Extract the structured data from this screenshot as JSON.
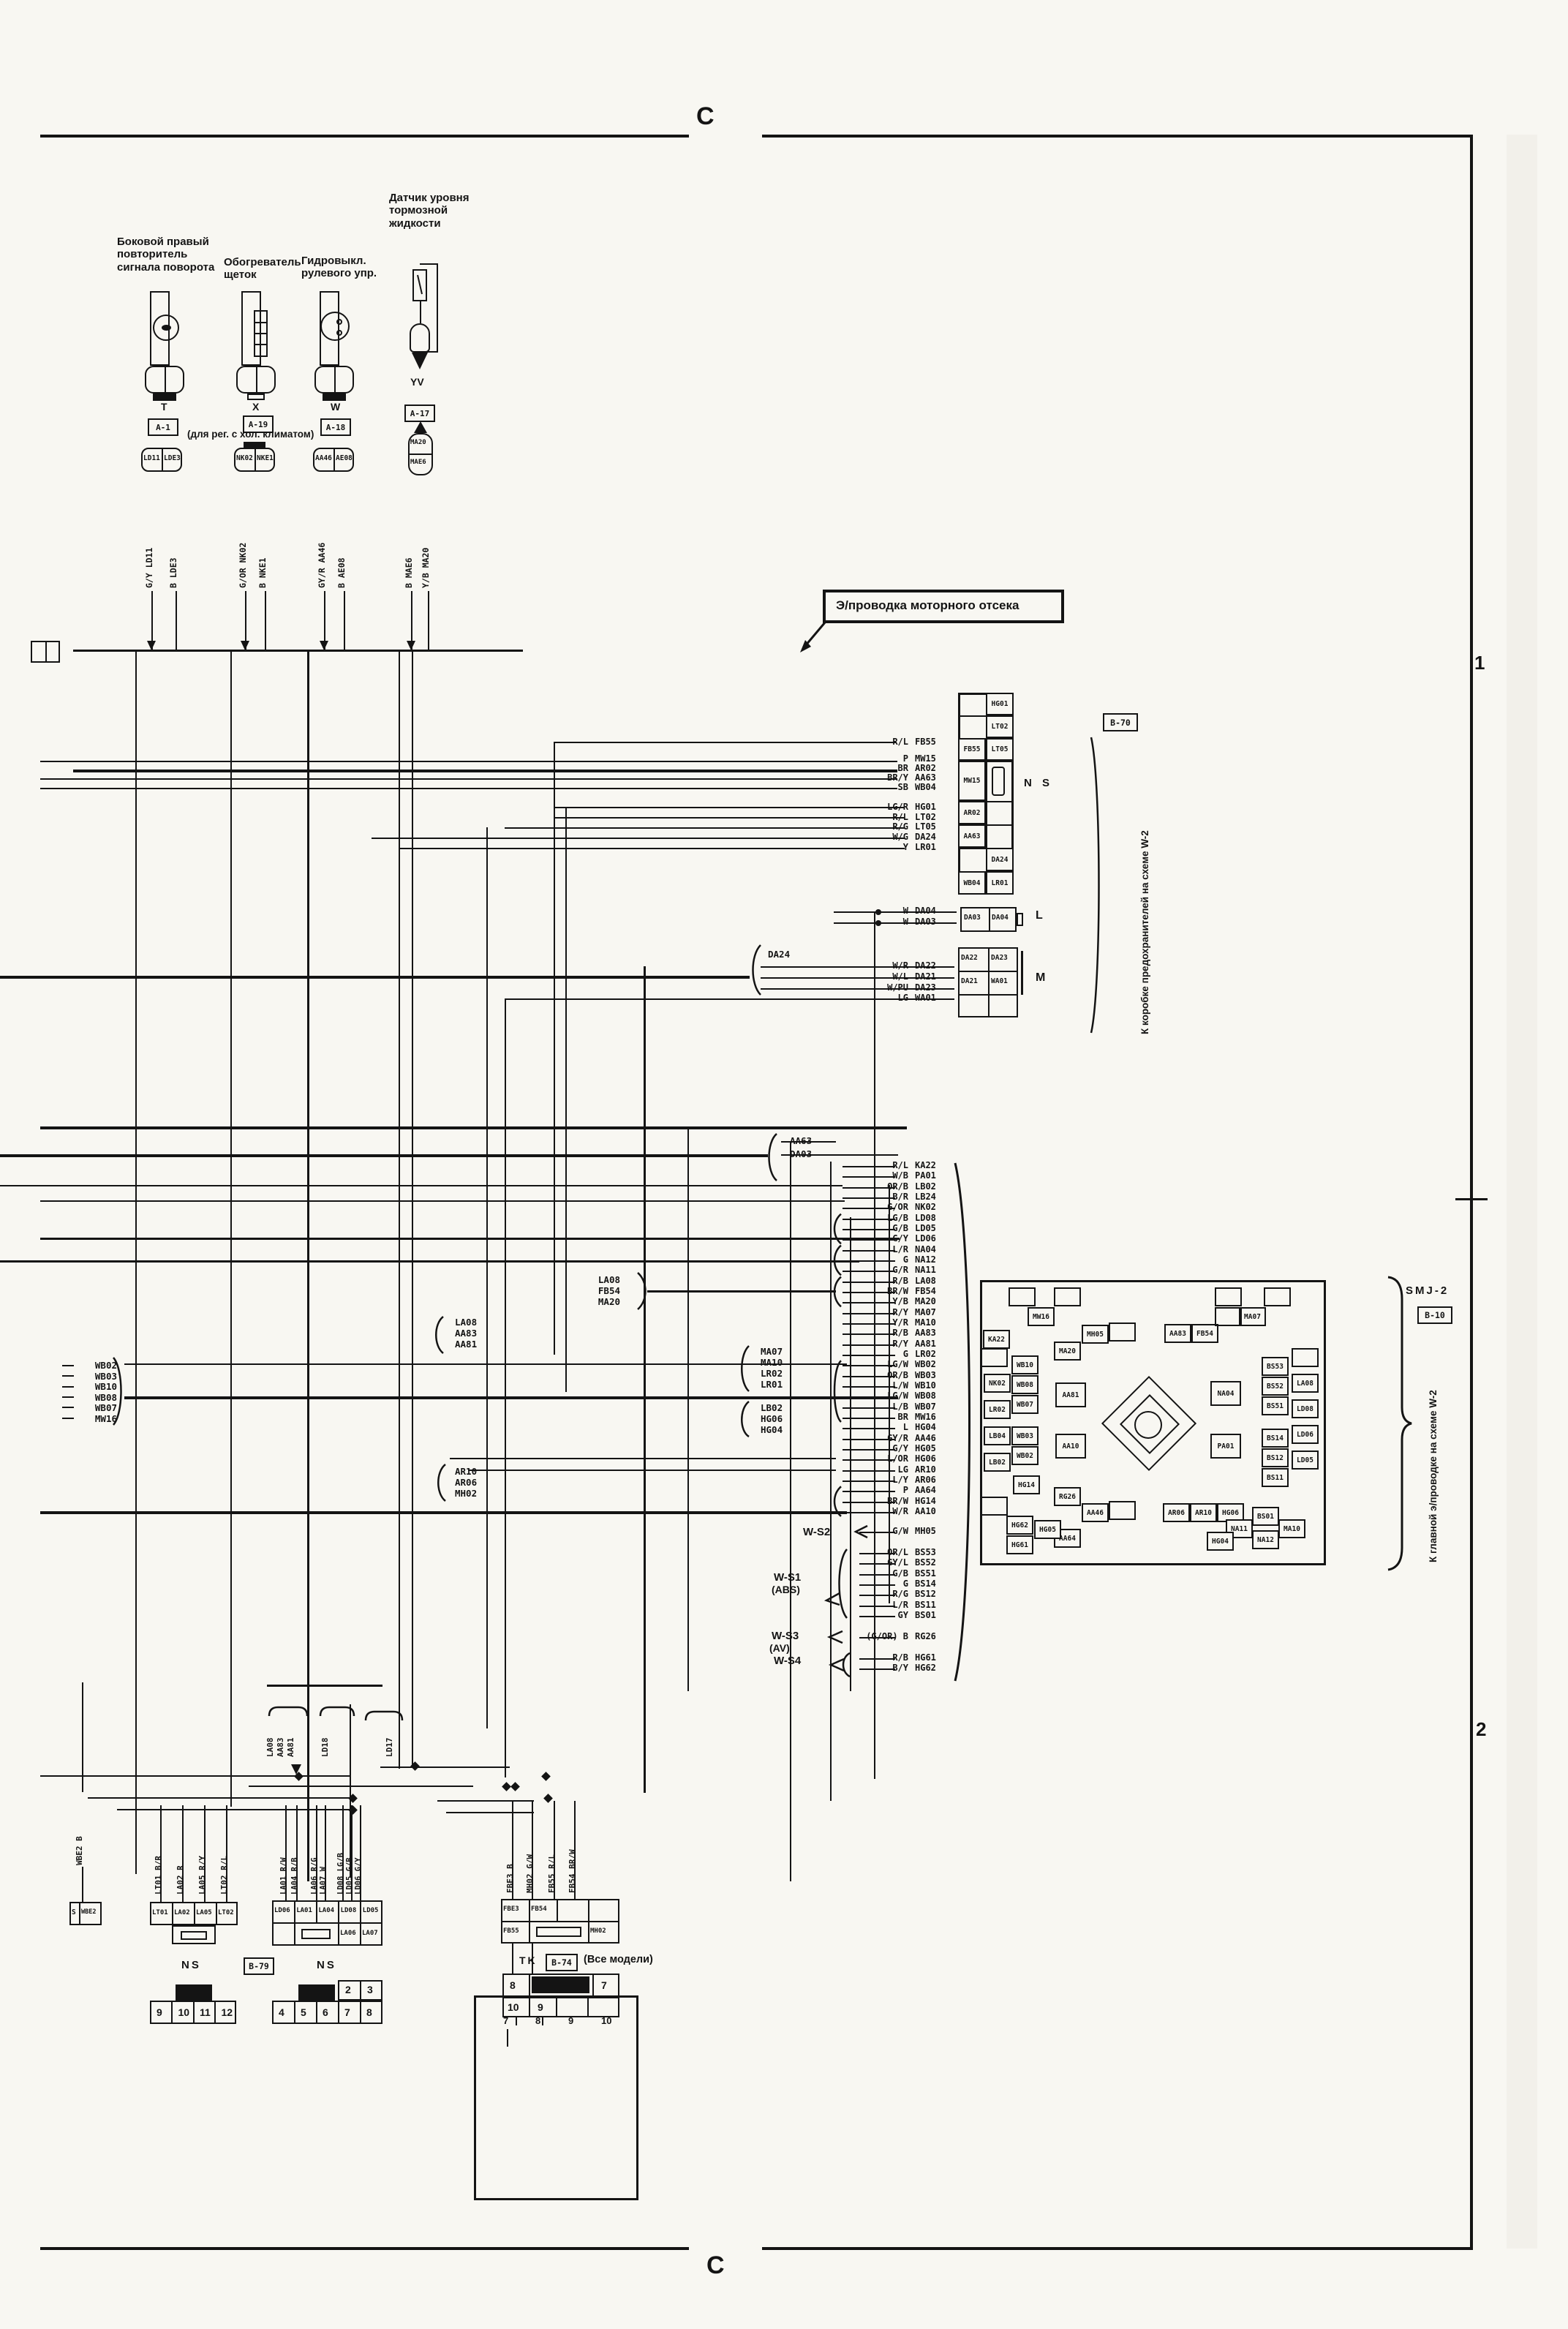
{
  "markers": {
    "section_top": "C",
    "section_bottom": "C",
    "row1": "1",
    "row2": "2"
  },
  "engine_label": "Э/проводка моторного отсека",
  "components": [
    {
      "name": "Боковой правый\nповторитель\nсигнала поворота",
      "code": "T",
      "conn": "A-1",
      "note": "",
      "pins": [
        "LD11",
        "LDE3"
      ],
      "wires": [
        "G/Y LD11",
        "B LDE3"
      ]
    },
    {
      "name": "Обогреватель\nщеток",
      "code": "X",
      "conn": "A-19",
      "note": "(для рег. с хол. климатом)",
      "pins": [
        "NK02",
        "NKE1"
      ],
      "wires": [
        "G/OR NK02",
        "B NKE1"
      ]
    },
    {
      "name": "Гидровыкл.\nрулевого упр.",
      "code": "W",
      "conn": "A-18",
      "note": "",
      "pins": [
        "AA46",
        "AE08"
      ],
      "wires": [
        "GY/R AA46",
        "B AE08"
      ]
    },
    {
      "name": "Датчик уровня\nтормозной\nжидкости",
      "code": "YV",
      "conn": "A-17",
      "note": "",
      "pins": [
        "MA20",
        "MAE6"
      ],
      "wires": [
        "B MAE6",
        "Y/B MA20"
      ]
    }
  ],
  "fusebox": {
    "ref": "B-70",
    "side_text": "К коробке предохранителей на схеме W-2",
    "ns_label": "N S",
    "ns_rows": [
      [
        "",
        "HG01"
      ],
      [
        "",
        "LT02"
      ],
      [
        "FB55",
        "LT05"
      ],
      [
        "MW15",
        ""
      ],
      [
        "AR02",
        ""
      ],
      [
        "AA63",
        ""
      ],
      [
        "",
        "DA24"
      ],
      [
        "WB04",
        "LR01"
      ]
    ],
    "ns_wires": [
      "R/L FB55",
      "P MW15",
      "BR AR02",
      "BR/Y AA63",
      "SB WB04",
      "LG/R HG01",
      "R/L LT02",
      "R/G LT05",
      "W/G DA24",
      "Y LR01"
    ],
    "l_label": "L",
    "l_cells": [
      "DA03",
      "DA04"
    ],
    "l_wires": [
      "W DA04",
      "W DA03"
    ],
    "m_label": "M",
    "m_rows": [
      [
        "DA22",
        "DA23"
      ],
      [
        "DA21",
        "WA01"
      ],
      [
        "",
        ""
      ]
    ],
    "m_wires": [
      "W/R DA22",
      "W/L DA21",
      "W/PU DA23",
      "LG WA01"
    ]
  },
  "mid_brackets": {
    "da24": [
      "DA24"
    ],
    "aa63": [
      "AA63",
      "DA03"
    ],
    "la08r": [
      "LA08",
      "FB54",
      "MA20"
    ],
    "la08l": [
      "LA08",
      "AA83",
      "AA81"
    ],
    "wb": [
      "WB02",
      "WB03",
      "WB10",
      "WB08",
      "WB07",
      "MW16"
    ],
    "ma": [
      "MA07",
      "MA10",
      "LR02",
      "LR01"
    ],
    "lb": [
      "LB02",
      "HG06",
      "HG04"
    ],
    "ar": [
      "AR10",
      "AR06",
      "MH02"
    ]
  },
  "smj": {
    "title": "SMJ-2",
    "ref": "B-10",
    "side_text": "К главной э/проводке на схеме W-2",
    "wire_list": [
      "R/L KA22",
      "W/B PA01",
      "OR/B LB02",
      "B/R LB24",
      "G/OR NK02",
      "LG/B LD08",
      "G/B LD05",
      "G/Y LD06",
      "L/R NA04",
      "G NA12",
      "G/R NA11",
      "R/B LA08",
      "BR/W FB54",
      "Y/B MA20",
      "R/Y MA07",
      "Y/R MA10",
      "R/B AA83",
      "R/Y AA81",
      "G LR02",
      "LG/W WB02",
      "OR/B WB03",
      "L/W WB10",
      "LG/W WB08",
      "L/B WB07",
      "BR MW16",
      "L HG04",
      "GY/R AA46",
      "G/Y HG05",
      "L/OR HG06",
      "LG AR10",
      "L/Y AR06",
      "P AA64",
      "BR/W HG14",
      "W/R AA10"
    ],
    "cells": [
      [
        "MW16",
        1405,
        1787
      ],
      [
        "KA22",
        1344,
        1818
      ],
      [
        "MA20",
        1441,
        1834
      ],
      [
        "MH05",
        1479,
        1811
      ],
      [
        "AA83",
        1592,
        1810
      ],
      [
        "FB54",
        1629,
        1810
      ],
      [
        "MA07",
        1694,
        1787
      ],
      [
        "WB10",
        1383,
        1853
      ],
      [
        "NK02",
        1345,
        1878
      ],
      [
        "WB08",
        1383,
        1880
      ],
      [
        "WB07",
        1383,
        1907
      ],
      [
        "LR02",
        1345,
        1914
      ],
      [
        "AA81",
        1443,
        1890,
        42,
        34
      ],
      [
        "NA04",
        1655,
        1888,
        42,
        34
      ],
      [
        "BS53",
        1725,
        1855
      ],
      [
        "BS52",
        1725,
        1882
      ],
      [
        "BS51",
        1725,
        1909
      ],
      [
        "LA08",
        1766,
        1878
      ],
      [
        "LD08",
        1766,
        1913
      ],
      [
        "LB04",
        1345,
        1950
      ],
      [
        "WB03",
        1383,
        1950
      ],
      [
        "WB02",
        1383,
        1977
      ],
      [
        "LB02",
        1345,
        1986
      ],
      [
        "HG14",
        1385,
        2017
      ],
      [
        "AA10",
        1443,
        1960,
        42,
        34
      ],
      [
        "PA01",
        1655,
        1960,
        42,
        34
      ],
      [
        "BS14",
        1725,
        1953
      ],
      [
        "BS12",
        1725,
        1980
      ],
      [
        "BS11",
        1725,
        2007
      ],
      [
        "LD06",
        1766,
        1948
      ],
      [
        "LD05",
        1766,
        1983
      ],
      [
        "RG26",
        1441,
        2033
      ],
      [
        "AA46",
        1479,
        2055
      ],
      [
        "AA64",
        1441,
        2090
      ],
      [
        "AR06",
        1590,
        2055
      ],
      [
        "AR10",
        1627,
        2055
      ],
      [
        "HG06",
        1664,
        2055
      ],
      [
        "HG62",
        1376,
        2072
      ],
      [
        "HG05",
        1414,
        2078
      ],
      [
        "HG61",
        1376,
        2099
      ],
      [
        "BS01",
        1712,
        2060
      ],
      [
        "NA11",
        1676,
        2077
      ],
      [
        "MA10",
        1748,
        2077
      ],
      [
        "NA12",
        1712,
        2092
      ],
      [
        "HG04",
        1650,
        2094
      ]
    ]
  },
  "ws_groups": [
    {
      "label": "W-S2",
      "sub": "",
      "wires": [
        "G/W MH05"
      ]
    },
    {
      "label": "W-S1",
      "sub": "(ABS)",
      "wires": [
        "OR/L BS53",
        "GY/L BS52",
        "G/B BS51",
        "G BS14",
        "R/G BS12",
        "L/R BS11",
        "GY BS01"
      ]
    },
    {
      "label": "W-S3",
      "sub": "(AV)",
      "wires": [
        "(G/OR) B RG26"
      ]
    },
    {
      "label": "W-S4",
      "sub": "",
      "wires": [
        "R/B HG61",
        "B/Y HG62"
      ]
    }
  ],
  "bottom": {
    "wbe2_cells": [
      "S",
      "WBE2"
    ],
    "wbe2_wire": "WBE2 B",
    "conn1_cells": [
      "LT01",
      "LA02",
      "LA05",
      "LT02"
    ],
    "conn1_wires": [
      "LT01 B/R",
      "LA02 R",
      "LA05 R/Y",
      "LT02 R/L"
    ],
    "conn2_top": [
      "LD06",
      "LA01",
      "LA04",
      "LD08",
      "LD05"
    ],
    "conn2_bot": [
      "LA06",
      "LA07"
    ],
    "conn2_wires": [
      "LA01 R/W",
      "LA04 R/B",
      "LA06 R/G",
      "LA07 W",
      "LD08 LG/B",
      "LD05 G/B",
      "LD06 G/Y"
    ],
    "conn3_top": [
      "FBE3",
      "FB54"
    ],
    "conn3_bot": [
      "FB55",
      "MH02"
    ],
    "conn3_wires": [
      "FBE3 B",
      "MH02 G/W",
      "FB55 R/L",
      "FB54 BR/W"
    ],
    "ns1": "NS",
    "b79": "B-79",
    "ns2": "NS",
    "tk": "TK",
    "b74": "B-74",
    "all_models": "(Все модели)",
    "pins_left": [
      "9",
      "10",
      "11",
      "12"
    ],
    "pins_mid": [
      "4",
      "5",
      "6",
      "7",
      "8"
    ],
    "pins_mid_top": [
      "2",
      "3"
    ],
    "tk_top": [
      "8",
      "7"
    ],
    "tk_bot": [
      "10",
      "9"
    ],
    "steer_pins": [
      "7",
      "8",
      "9",
      "10"
    ],
    "sensor_block": "Блок датчиков",
    "horn": "Клаксон",
    "module": "Модуль",
    "four": "4",
    "wheel_label1": "Рулевое колесо (подушка без.",
    "wheel_label2": "только со стороны водителя)",
    "headlight_label": "Перекл. света фар",
    "combo_label": "Комбинированный переключатель",
    "turn_label1": "Перекл.",
    "turn_label2": "сигнала поворота",
    "vert_groups": [
      [
        "LA08",
        "AA83",
        "AA81"
      ],
      [
        "LD18"
      ],
      [
        "LD17"
      ]
    ]
  },
  "headlight_table": {
    "groups": [
      "OFF",
      "1",
      "2"
    ],
    "subs": [
      "M",
      "D",
      "P"
    ],
    "rows": [
      "10",
      "2",
      "3",
      "5",
      "6",
      "11",
      "9",
      "12"
    ],
    "dots": [
      [
        2,
        5,
        6,
        7,
        8
      ],
      [
        2,
        5,
        6,
        8
      ],
      [
        7
      ],
      [
        2,
        5,
        6,
        7,
        8
      ],
      [
        2,
        5,
        6,
        8
      ],
      [
        7
      ],
      [
        3,
        4,
        5,
        6,
        7,
        8
      ],
      [
        3,
        4,
        5,
        6,
        7,
        8
      ]
    ]
  },
  "turn_table": {
    "cols": [
      "L",
      "N",
      "R"
    ],
    "rows": [
      "7",
      "8",
      "4"
    ],
    "dots": [
      [
        0,
        2
      ],
      [
        0
      ],
      [
        2
      ]
    ]
  },
  "onwash_table": {
    "cols": [
      "ON",
      "WASH"
    ],
    "dots": [
      [
        0,
        1
      ],
      [
        1
      ],
      [
        0,
        1
      ]
    ]
  }
}
